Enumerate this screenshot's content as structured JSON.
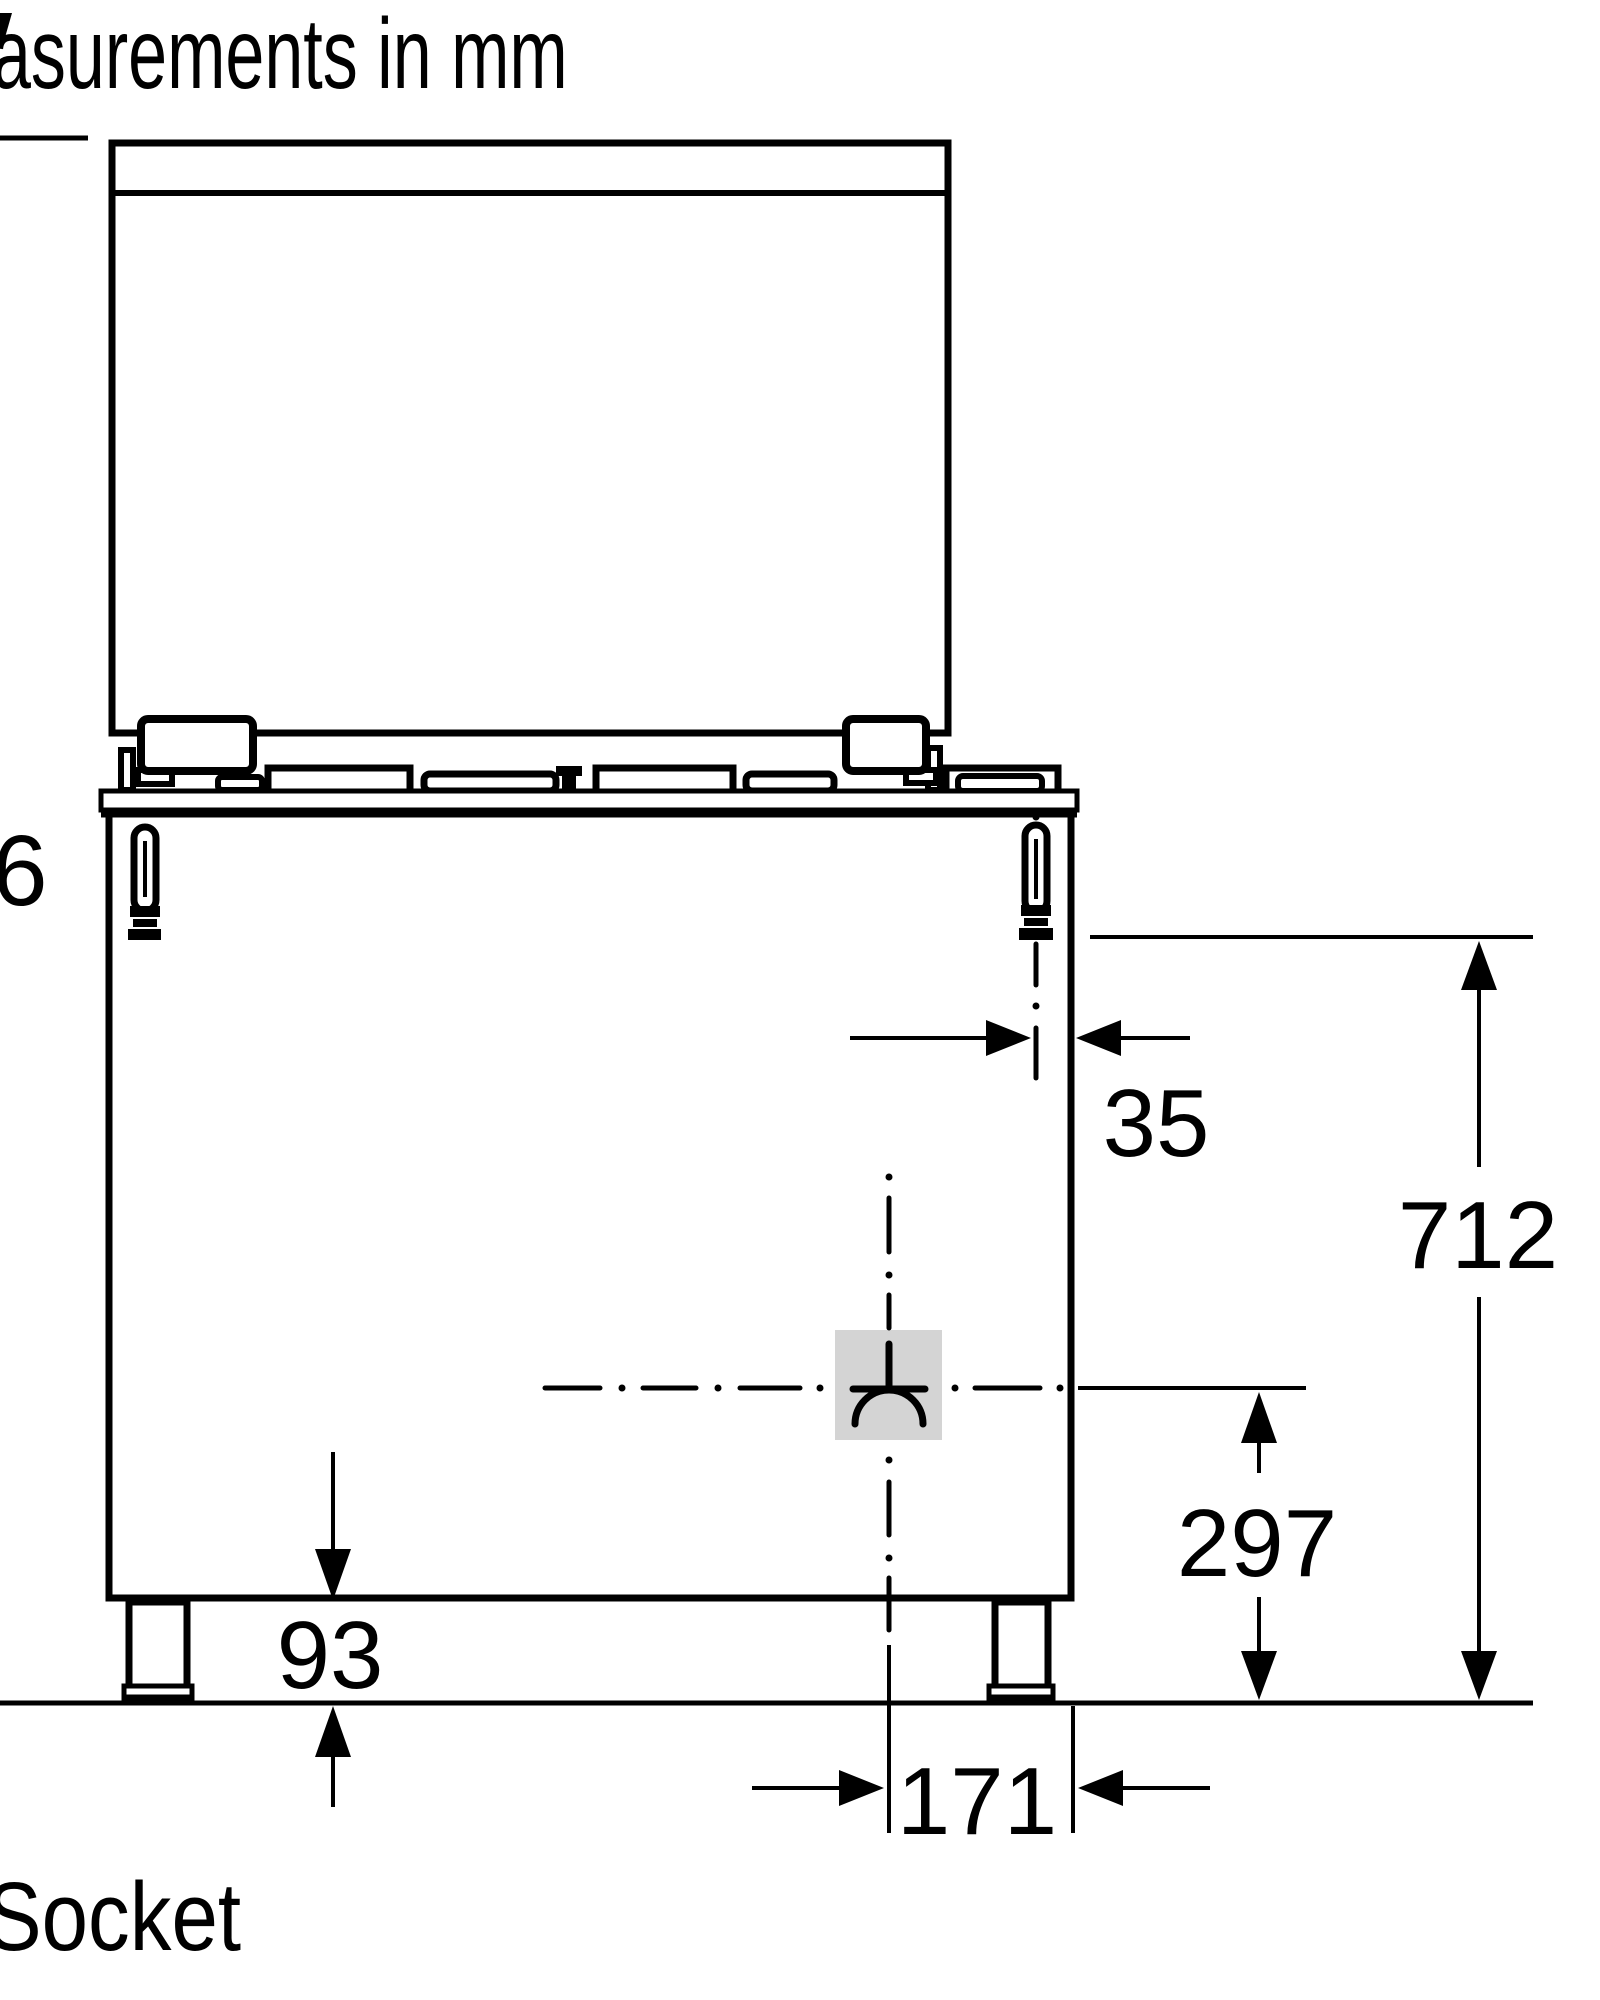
{
  "drawing": {
    "title": "asurements in mm",
    "socket_label": "Socket",
    "left_edge_value": "6"
  },
  "dimensions": {
    "gas_offset": "35",
    "gas_height": "712",
    "socket_height": "297",
    "leg_height": "93",
    "socket_offset": "171"
  },
  "colors": {
    "line": "#000000",
    "background": "#ffffff",
    "socket_highlight": "#d4d4d4"
  }
}
